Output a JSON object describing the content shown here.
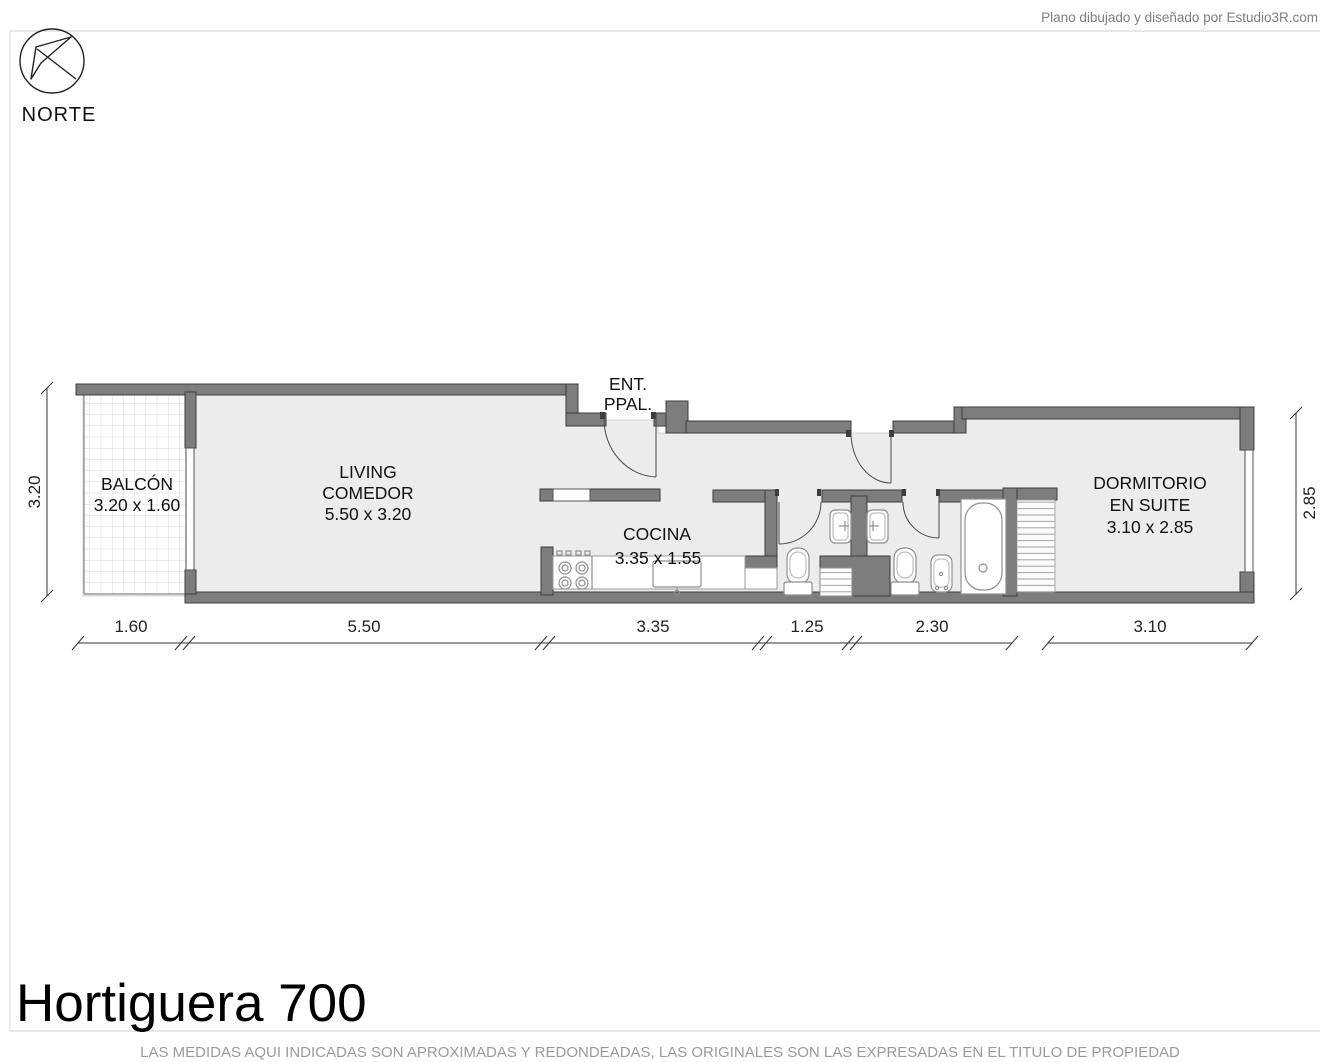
{
  "credit": "Plano dibujado y diseñado por Estudio3R.com",
  "compass": {
    "label": "NORTE"
  },
  "rooms": {
    "balcon": {
      "name": "BALCÓN",
      "size": "3.20 x 1.60"
    },
    "living": {
      "name1": "LIVING",
      "name2": "COMEDOR",
      "size": "5.50 x 3.20"
    },
    "entrance": {
      "line1": "ENT.",
      "line2": "PPAL."
    },
    "cocina": {
      "name": "COCINA",
      "size": "3.35 x 1.55"
    },
    "dormitorio": {
      "name1": "DORMITORIO",
      "name2": "EN SUITE",
      "size": "3.10 x 2.85"
    }
  },
  "dimensions": {
    "left": "3.20",
    "right": "2.85",
    "bottom": [
      "1.60",
      "5.50",
      "3.35",
      "1.25",
      "2.30",
      "3.10"
    ]
  },
  "footer": {
    "title": "Hortiguera 700",
    "disclaimer": "LAS MEDIDAS AQUI INDICADAS SON APROXIMADAS Y REDONDEADAS, LAS ORIGINALES SON LAS EXPRESADAS EN EL TITULO DE PROPIEDAD"
  },
  "colors": {
    "wall": "#7d7d7d",
    "floor": "#ececec",
    "accent_text": "#111111"
  }
}
